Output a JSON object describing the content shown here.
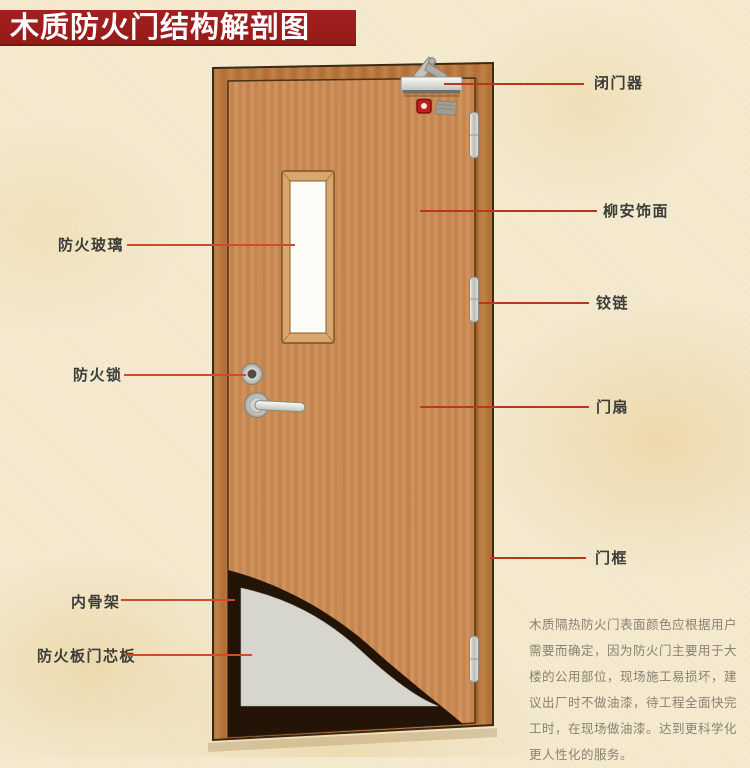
{
  "title": "木质防火门结构解剖图",
  "callouts": {
    "door_closer": {
      "label": "闭门器"
    },
    "veneer": {
      "label": "柳安饰面"
    },
    "hinge": {
      "label": "铰链"
    },
    "door_leaf": {
      "label": "门扇"
    },
    "door_frame": {
      "label": "门框"
    },
    "fire_glass": {
      "label": "防火玻璃"
    },
    "fire_lock": {
      "label": "防火锁"
    },
    "inner_skeleton": {
      "label": "内骨架"
    },
    "core_panel": {
      "label": "防火板门芯板"
    }
  },
  "description": {
    "lines": [
      "木质隔热防火门表面颜色应根据用户",
      "需要而确定，因为防火门主要用于大",
      "楼的公用部位，现场施工易损坏，建",
      "议出厂时不做油漆，待工程全面快完",
      "工时，在现场做油漆。达到更科学化",
      "更人性化的服务。"
    ]
  },
  "colors": {
    "banner_red": "#9e1e1c",
    "leader_line_left": "#d04b26",
    "leader_line_right": "#b8381d",
    "door_wood": "#c98c58",
    "door_frame_wood": "#bb7a42",
    "core_panel_gray": "#d6d6ce",
    "cutaway_dark": "#241407",
    "background_cream": "#f3ead0",
    "glass_white": "#fbfbf8"
  }
}
